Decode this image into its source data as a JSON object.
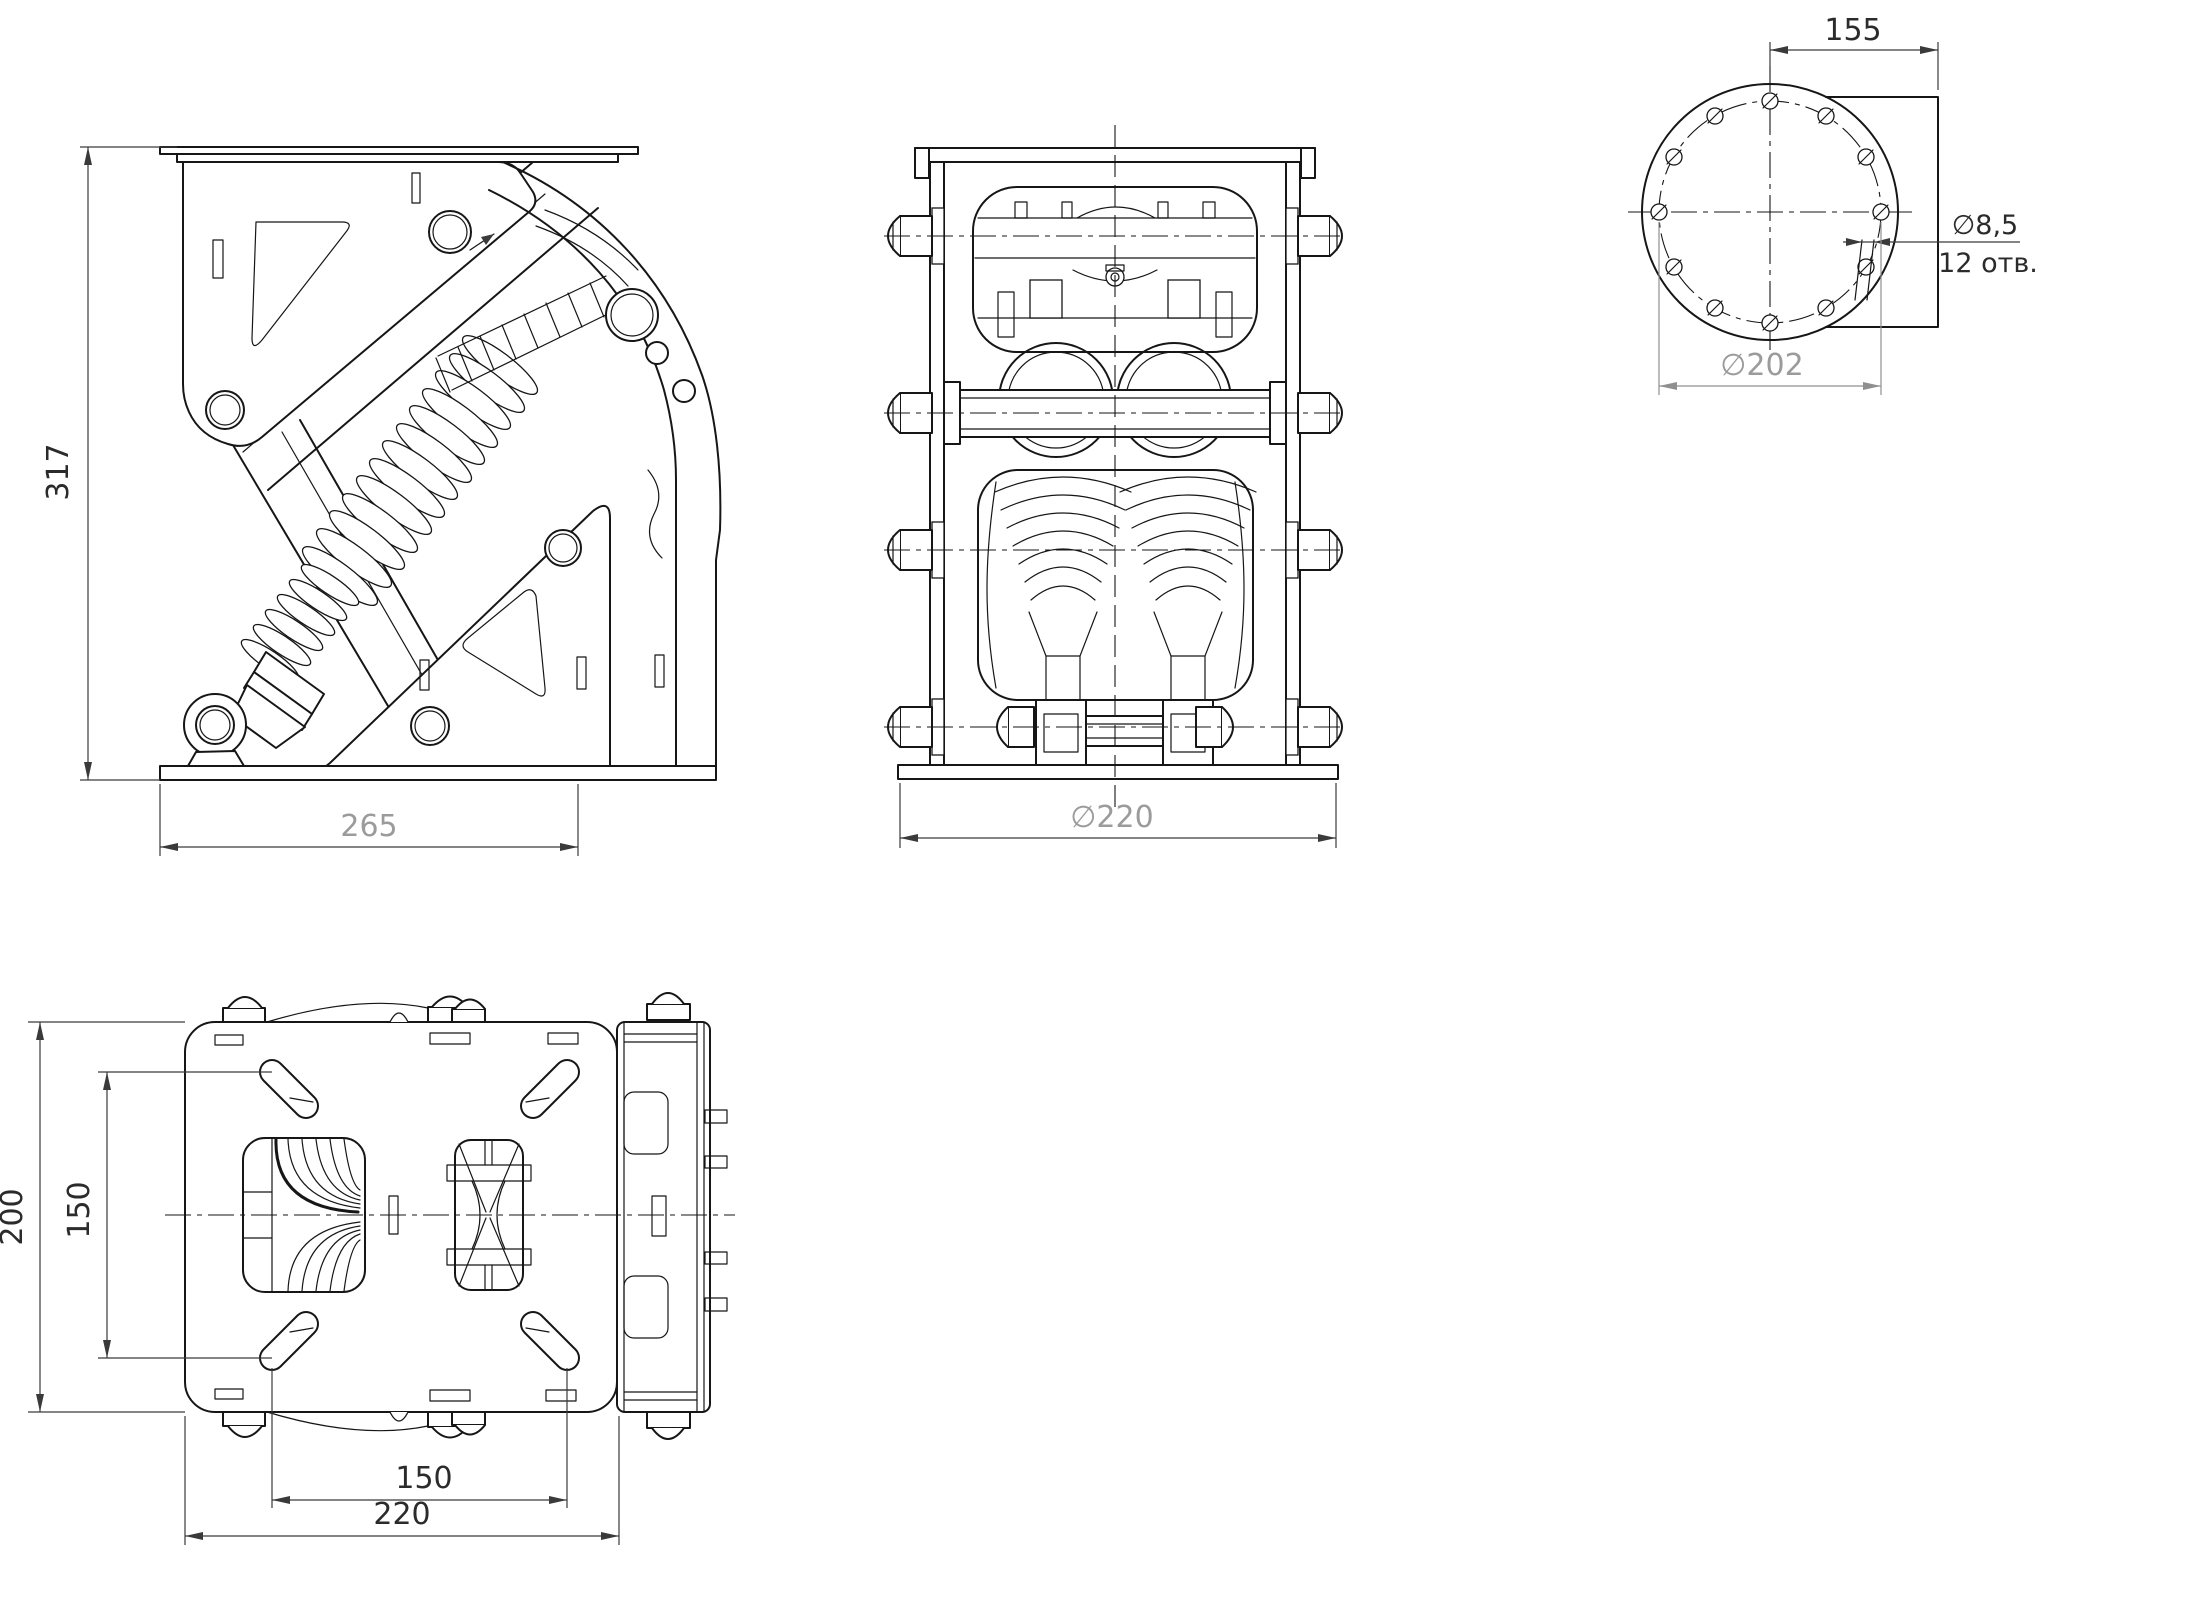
{
  "meta": {
    "type": "engineering-drawing",
    "language": "ru",
    "background_color": "#ffffff",
    "line_color": "#161616",
    "dim_text_color": "#2b2b2b",
    "dim_gray_color": "#9b9b9b"
  },
  "views": {
    "side": {
      "label": "side-view",
      "height_dim": "317",
      "base_dim": "265"
    },
    "front": {
      "label": "front-view",
      "base_diameter_dim": "∅220"
    },
    "flange": {
      "label": "flange-face-view",
      "offset_dim": "155",
      "hole_diameter_dim": "∅8,5",
      "hole_count_note": "12 отв.",
      "bolt_circle_dim": "∅202"
    },
    "plan": {
      "label": "plan-view",
      "height_dim": "200",
      "inner_height_dim": "150",
      "inner_width_dim": "150",
      "width_dim": "220"
    }
  }
}
